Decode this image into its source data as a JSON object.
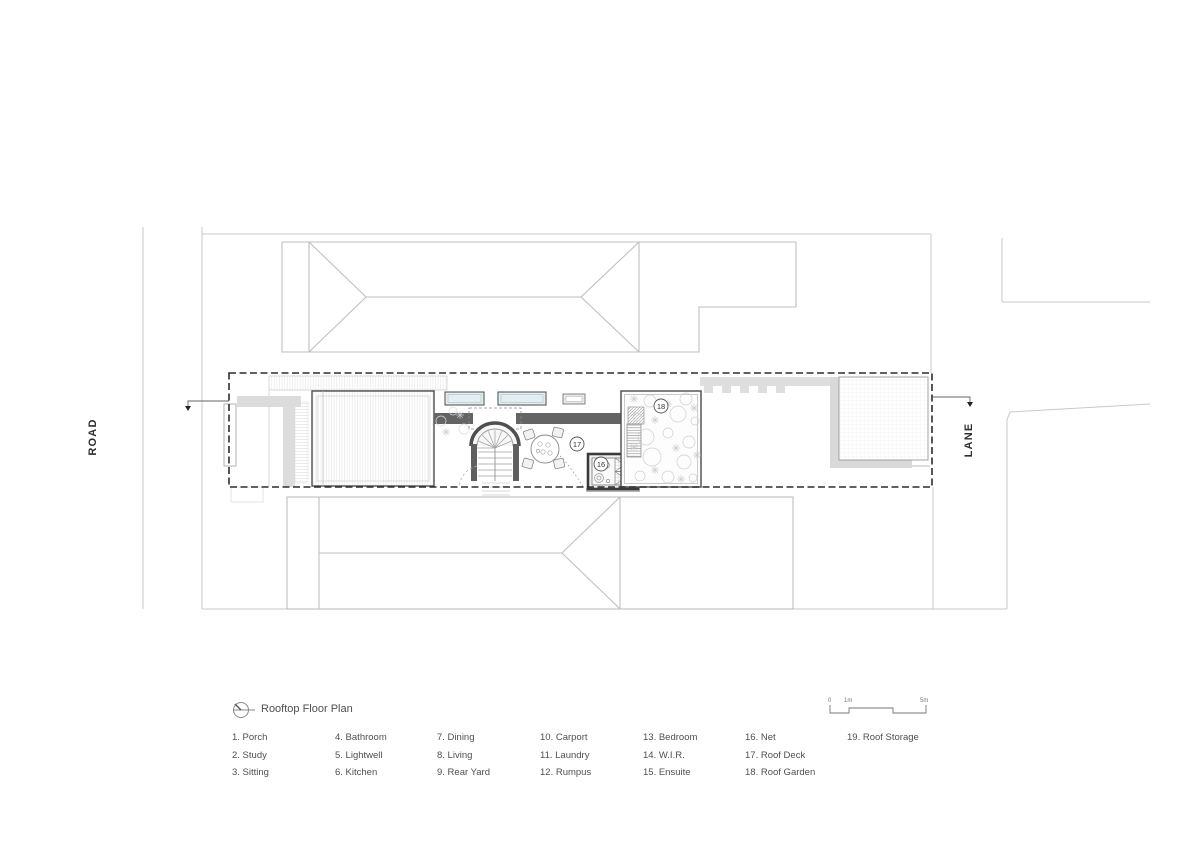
{
  "title_block": {
    "title": "Rooftop Floor Plan"
  },
  "streets": {
    "road": "ROAD",
    "lane": "LANE"
  },
  "plan_labels": {
    "net": "16",
    "roof_deck": "17",
    "roof_garden": "18"
  },
  "scale_bar": {
    "labels": [
      "0",
      "1m",
      "5m"
    ]
  },
  "legend": {
    "columns": [
      [
        "1. Porch",
        "2. Study",
        "3. Sitting"
      ],
      [
        "4. Bathroom",
        "5. Lightwell",
        "6. Kitchen"
      ],
      [
        "7. Dining",
        "8. Living",
        "9. Rear Yard"
      ],
      [
        "10. Carport",
        "11. Laundry",
        "12. Rumpus"
      ],
      [
        "13. Bedroom",
        "14. W.I.R.",
        "15. Ensuite"
      ],
      [
        "16. Net",
        "17. Roof Deck",
        "18. Roof Garden"
      ],
      [
        "19. Roof Storage"
      ]
    ]
  },
  "colors": {
    "background": "#ffffff",
    "boundary_dashed": "#2d2d2d",
    "wall_dark": "#5f5f5f",
    "wall_light": "#dcdcdc",
    "neighbor_lines": "#bfbfbf",
    "road_lines": "#c9c9c9",
    "skylight_fill": "#e3eef0",
    "text_gray": "#4f4f4f"
  }
}
